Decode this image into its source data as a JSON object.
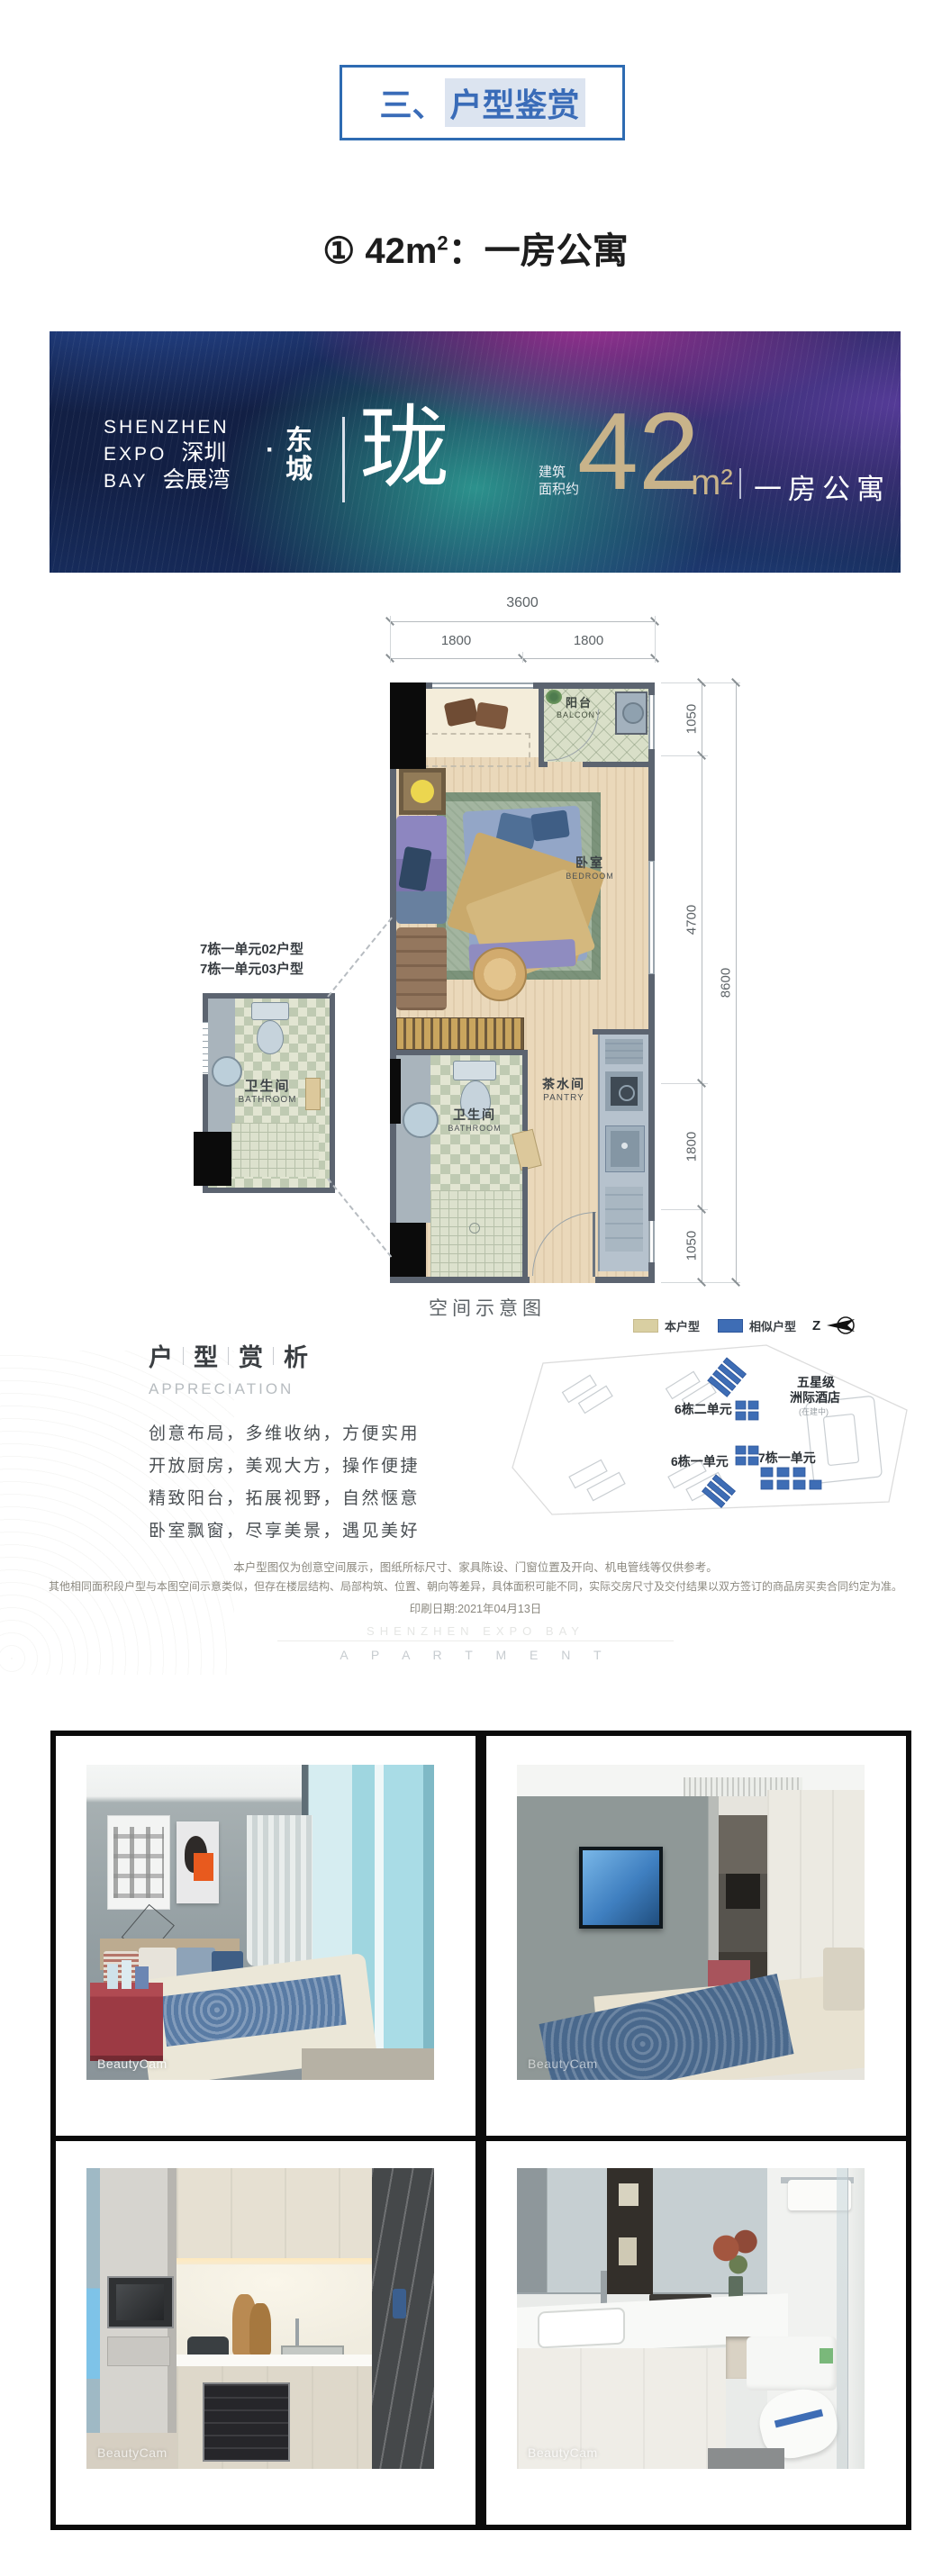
{
  "section_header": {
    "prefix": "三、",
    "highlight": "户型鉴赏"
  },
  "unit_heading": {
    "circled_index": "①",
    "area": "42m",
    "area_sup": "2",
    "suffix": "：一房公寓"
  },
  "banner": {
    "brand_en_1": "SHENZHEN",
    "brand_en_2": "EXPO",
    "brand_en_3": "BAY",
    "brand_cn_1": "深圳",
    "brand_cn_2": "会展湾",
    "dot": "·",
    "district_char_1": "东",
    "district_char_2": "城",
    "project_name": "珑",
    "area_caption_1": "建筑",
    "area_caption_2": "面积约",
    "area_number": "42",
    "area_unit": "m²",
    "type_label": "一房公寓"
  },
  "floorplan": {
    "caption": "空间示意图",
    "dims_top": {
      "total": "3600",
      "left": "1800",
      "right": "1800"
    },
    "dims_right": {
      "seg1": "1050",
      "seg2": "4700",
      "seg3": "1800",
      "seg4": "1050",
      "total": "8600"
    },
    "rooms": {
      "balcony_cn": "阳台",
      "balcony_en": "BALCONY",
      "bedroom_cn": "卧室",
      "bedroom_en": "BEDROOM",
      "bathroom_cn": "卫生间",
      "bathroom_en": "BATHROOM",
      "pantry_cn": "茶水间",
      "pantry_en": "PANTRY"
    },
    "detail_inset": {
      "label_line1": "7栋一单元02户型",
      "label_line2": "7栋一单元03户型",
      "bathroom_cn": "卫生间",
      "bathroom_en": "BATHROOM"
    }
  },
  "appreciation": {
    "title_chars": [
      "户",
      "型",
      "赏",
      "析"
    ],
    "subtitle": "APPRECIATION",
    "lines": [
      "创意布局，多维收纳，方便实用",
      "开放厨房，美观大方，操作便捷",
      "精致阳台，拓展视野，自然惬意",
      "卧室飘窗，尽享美景，遇见美好"
    ]
  },
  "sitemap": {
    "legend": {
      "this_unit": "本户型",
      "similar_unit": "相似户型",
      "north_label": "Z"
    },
    "colors": {
      "this_unit": "#d9cfa2",
      "similar_unit": "#3e6db5"
    },
    "labels": {
      "hotel_line1": "五星级",
      "hotel_line2": "洲际酒店",
      "hotel_note": "(在建中)",
      "bldg_6_2": "6栋二单元",
      "bldg_6_1": "6栋一单元",
      "bldg_7_1": "7栋一单元"
    }
  },
  "disclaimer": {
    "line1": "本户型图仅为创意空间展示，图纸所标尺寸、家具陈设、门窗位置及开向、机电管线等仅供参考。",
    "line2": "其他相同面积段户型与本图空间示意类似，但存在楼层结构、局部构筑、位置、朝向等差异，具体面积可能不同，实际交房尺寸及交付结果以双方签订的商品房买卖合同约定为准。",
    "line3": "印刷日期:2021年04月13日"
  },
  "watermark": {
    "line1": "SHENZHEN EXPO BAY",
    "line2": "A P A R T M E N T"
  },
  "photos": {
    "bedroom": {
      "watermark": "BeautyCam"
    },
    "bedroom_tv": {
      "watermark": "BeautyCam"
    },
    "kitchen": {
      "watermark": "BeautyCam"
    },
    "bathroom": {
      "watermark": "BeautyCam"
    }
  }
}
